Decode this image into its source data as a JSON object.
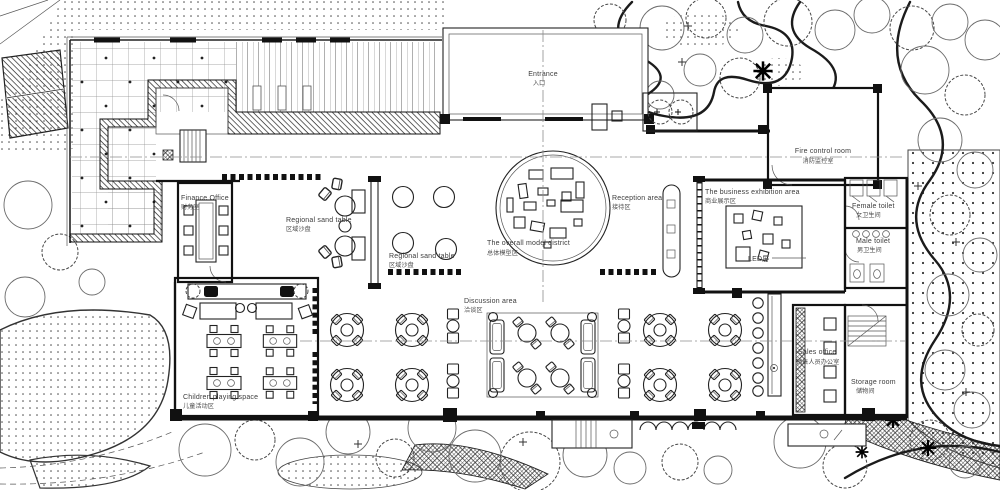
{
  "plan": {
    "labels": {
      "entrance": {
        "en": "Entrance",
        "zh": "入口"
      },
      "fire_control": {
        "en": "Fire control room",
        "zh": "消防监控室"
      },
      "finance_office": {
        "en": "Finance Office",
        "zh": "财务室"
      },
      "sand_table_1": {
        "en": "Regional sand table",
        "zh": "区域沙盘"
      },
      "sand_table_2": {
        "en": "Regional sand table",
        "zh": "区域沙盘"
      },
      "overall_model": {
        "en": "The overall model district",
        "zh": "总体模型区"
      },
      "reception": {
        "en": "Reception area",
        "zh": "接待区"
      },
      "business_exhibit": {
        "en": "The business exhibition area",
        "zh": "商业展示区"
      },
      "led_screen": {
        "en": "LED屏"
      },
      "female_toilet": {
        "en": "Female toilet",
        "zh": "女卫生间"
      },
      "male_toilet": {
        "en": "Male toilet",
        "zh": "男卫生间"
      },
      "discussion": {
        "en": "Discussion area",
        "zh": "洽谈区"
      },
      "children": {
        "en": "Children playing space",
        "zh": "儿童活动区"
      },
      "sales_office": {
        "en": "Sales office",
        "zh": "销售人员办公室"
      },
      "storage": {
        "en": "Storage room",
        "zh": "储物间"
      }
    },
    "colors": {
      "ink": "#111111",
      "label": "#3c3c3c",
      "background": "#ffffff"
    }
  }
}
